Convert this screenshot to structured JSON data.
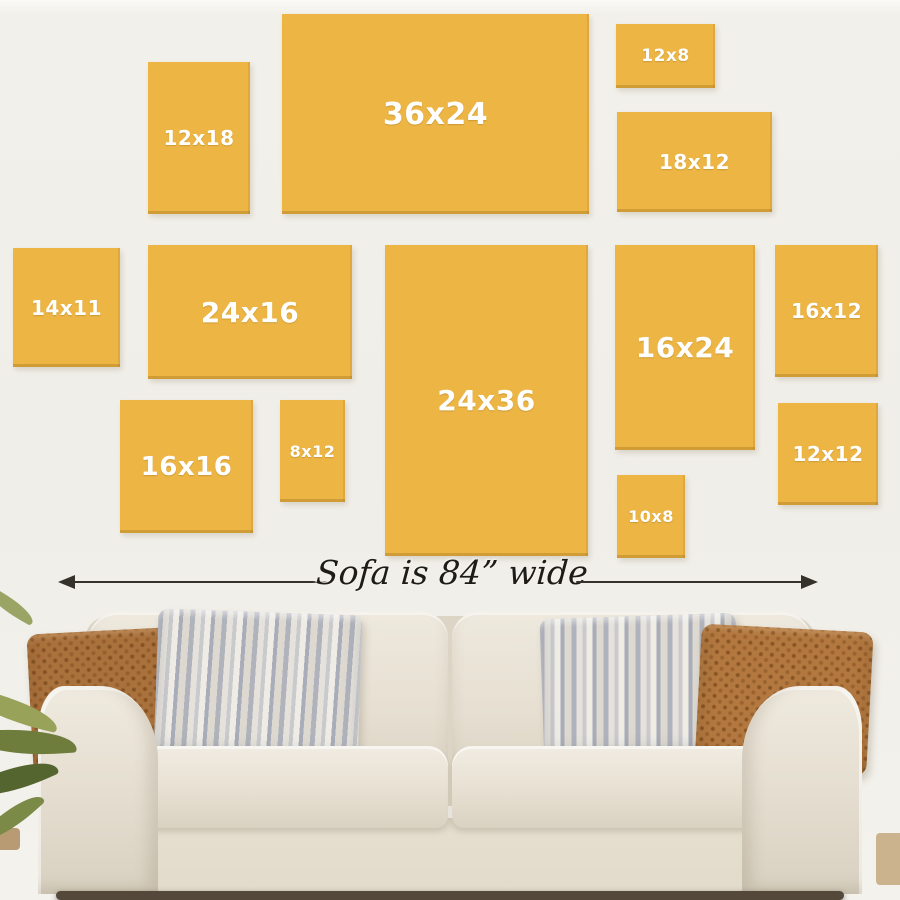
{
  "wall": {
    "canvases": [
      {
        "label": "12x18",
        "x": 148,
        "y": 62,
        "w": 102,
        "h": 152,
        "font": 20
      },
      {
        "label": "36x24",
        "x": 282,
        "y": 14,
        "w": 307,
        "h": 200,
        "font": 30
      },
      {
        "label": "12x8",
        "x": 616,
        "y": 24,
        "w": 99,
        "h": 64,
        "font": 17
      },
      {
        "label": "18x12",
        "x": 617,
        "y": 112,
        "w": 155,
        "h": 100,
        "font": 20
      },
      {
        "label": "14x11",
        "x": 13,
        "y": 248,
        "w": 107,
        "h": 119,
        "font": 20
      },
      {
        "label": "24x16",
        "x": 148,
        "y": 245,
        "w": 204,
        "h": 134,
        "font": 28
      },
      {
        "label": "24x36",
        "x": 385,
        "y": 245,
        "w": 203,
        "h": 311,
        "font": 28
      },
      {
        "label": "16x24",
        "x": 615,
        "y": 245,
        "w": 140,
        "h": 205,
        "font": 28
      },
      {
        "label": "16x12",
        "x": 775,
        "y": 245,
        "w": 103,
        "h": 132,
        "font": 20
      },
      {
        "label": "16x16",
        "x": 120,
        "y": 400,
        "w": 133,
        "h": 133,
        "font": 26
      },
      {
        "label": "8x12",
        "x": 280,
        "y": 400,
        "w": 65,
        "h": 102,
        "font": 16
      },
      {
        "label": "10x8",
        "x": 617,
        "y": 475,
        "w": 68,
        "h": 83,
        "font": 16
      },
      {
        "label": "12x12",
        "x": 778,
        "y": 403,
        "w": 100,
        "h": 102,
        "font": 20
      }
    ]
  },
  "measure": {
    "label": "Sofa is 84” wide"
  },
  "colors": {
    "wall": "#f0eee8",
    "canvas": "#ecb544",
    "canvas-label": "#ffffff",
    "arrow": "#35322c",
    "pillow-brown": "#a9713c",
    "pillow-brown2": "#b27840",
    "floor": "#b89b72"
  }
}
